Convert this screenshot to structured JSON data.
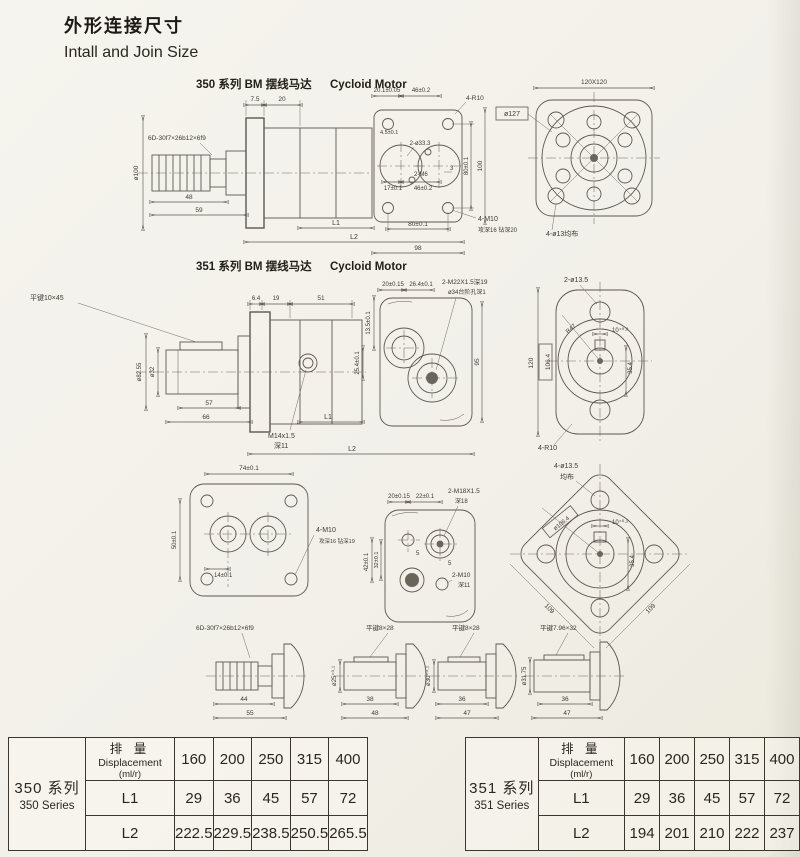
{
  "title": {
    "zh": "外形连接尺寸",
    "en": "Intall and Join Size"
  },
  "sections": {
    "s350": {
      "series": "350 系列 BM 摆线马达",
      "type": "Cycloid Motor"
    },
    "s351": {
      "series": "351 系列 BM 摆线马达",
      "type": "Cycloid Motor"
    }
  },
  "r1": {
    "spline": "6D-30f7×26b12×6f9",
    "d75": "7.5",
    "d20": "20",
    "d201": "20.1±0.05",
    "dia100": "ø100",
    "d48": "48",
    "d59": "59",
    "L1": "L1",
    "L2": "L2",
    "d46t": "46±0.2",
    "d45": "4.5±0.1",
    "ports": "2-ø33.3",
    "m6": "2-M6",
    "d17": "17±0.1",
    "d46b": "46±0.2",
    "d3": "3",
    "d80b": "80±0.1",
    "d98": "98",
    "d80r": "80±0.1",
    "d100r": "100",
    "r10": "4-R10",
    "dia127": "ø127",
    "m10": "4-M10",
    "m10note": "攻深16 钻深20",
    "sq": "120X120",
    "holes": "4-ø13均布"
  },
  "r2": {
    "key": "平键10×45",
    "d64": "6.4",
    "d19": "19",
    "d51": "51",
    "dia8255": "ø82.55",
    "dia32": "ø32",
    "m14": "M14x1.5",
    "m14note": "深11",
    "d57": "57",
    "d66": "66",
    "L1": "L1",
    "L2": "L2",
    "d20": "20±0.15",
    "d264": "26.4±0.1",
    "m22": "2-M22X1.5深19",
    "m22note": "ø34台阶孔深1",
    "d135": "13.5±0.1",
    "d254": "25.4±0.1",
    "d95": "95",
    "holes": "2-ø13.5",
    "r47": "R47",
    "slot": "10⁺⁰·²",
    "d354": "35.4",
    "d120": "120",
    "d1064": "106.4",
    "r10": "4-R10"
  },
  "r3": {
    "d74": "74±0.1",
    "d50": "50±0.1",
    "d14": "14±0.1",
    "m10": "4-M10",
    "m10note": "攻深16 钻深19",
    "d20": "20±0.15",
    "d22": "22±0.1",
    "m18": "2-M18X1.5",
    "m18note": "深18",
    "d42": "42±0.1",
    "d32": "32±0.1",
    "d5a": "5",
    "d5b": "5",
    "m10b": "2-M10",
    "m10bnote": "深11",
    "holes": "4-ø13.5",
    "holes2": "均布",
    "dia1064": "ø106.4",
    "slot": "10⁺⁰·²",
    "d354": "35.4",
    "e109a": "109",
    "e109b": "109"
  },
  "r4": {
    "s1": {
      "label": "6D-30f7×26b12×6f9",
      "d1": "44",
      "d2": "55"
    },
    "s2": {
      "label": "平键8×28",
      "dia": "ø25⁺⁰·¹",
      "d1": "38",
      "d2": "48"
    },
    "s3": {
      "label": "平键8×28",
      "dia": "ø30⁺⁰·¹",
      "d1": "36",
      "d2": "47"
    },
    "s4": {
      "label": "平键7.96×32",
      "dia": "ø31.75",
      "d1": "36",
      "d2": "47"
    }
  },
  "tables": [
    {
      "series_zh": "350 系列",
      "series_en": "350 Series",
      "h1": "排  量",
      "h2": "Displacement",
      "h3": "(ml/r)",
      "cols": [
        "160",
        "200",
        "250",
        "315",
        "400"
      ],
      "rows": [
        {
          "label": "L1",
          "vals": [
            "29",
            "36",
            "45",
            "57",
            "72"
          ]
        },
        {
          "label": "L2",
          "vals": [
            "222.5",
            "229.5",
            "238.5",
            "250.5",
            "265.5"
          ]
        }
      ]
    },
    {
      "series_zh": "351 系列",
      "series_en": "351 Series",
      "h1": "排  量",
      "h2": "Displacement",
      "h3": "(ml/r)",
      "cols": [
        "160",
        "200",
        "250",
        "315",
        "400"
      ],
      "rows": [
        {
          "label": "L1",
          "vals": [
            "29",
            "36",
            "45",
            "57",
            "72"
          ]
        },
        {
          "label": "L2",
          "vals": [
            "194",
            "201",
            "210",
            "222",
            "237"
          ]
        }
      ]
    }
  ]
}
